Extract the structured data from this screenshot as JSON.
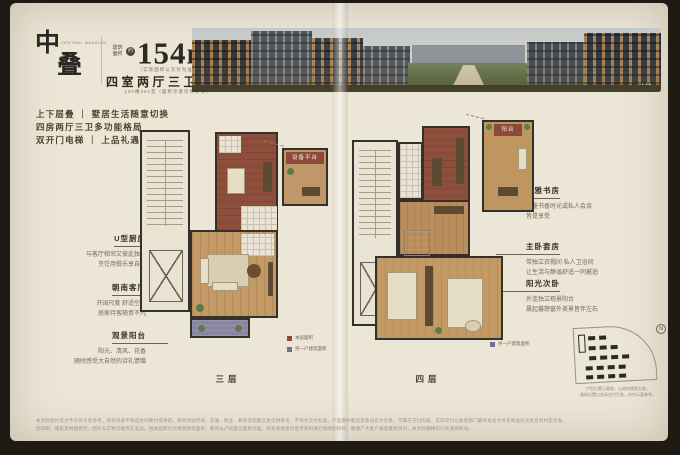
{
  "brand": {
    "logo_char_top": "中",
    "logo_char_bottom": "叠",
    "logo_subtext": "CENTRAL MANSION"
  },
  "headline": {
    "area_label": "建筑面积",
    "area_approx": "约",
    "area_value": "154m",
    "area_sup": "2",
    "area_note": "（实际面积以交付为准）",
    "layout": "四室两厅三卫一厨",
    "unit_note": "10#楼301室（面积示意仅供参考）"
  },
  "selling_points": [
    "上下层叠 ｜ 墅居生活随意切换",
    "四房两厅三卫多功能格局",
    "双开门电梯 ｜ 上品礼遇"
  ],
  "left_annotations": [
    {
      "title": "U型厨房",
      "line1": "与客厅相邻又彼此独立",
      "line2": "烹饪用餐乐享自在"
    },
    {
      "title": "朝南客厅",
      "line1": "开阔尺度 舒适空间",
      "line2": "居家待客随意不凡"
    },
    {
      "title": "观景阳台",
      "line1": "阳光、清风、花香",
      "line2": "随时感受大自然的诗礼馈赠"
    }
  ],
  "right_annotations": [
    {
      "title": "静雅书房",
      "line1": "翰墨书香时光或私人会谈",
      "line2": "皆是享受"
    },
    {
      "title": "主卧套房",
      "line1": "带独立衣帽间 私人卫浴间",
      "line2": "让生活与静谧舒适一同邂逅"
    },
    {
      "title": "阳光次卧",
      "line1": "外连独立观景阳台",
      "line2": "晨起暮憩窗外美景皆伴左右"
    }
  ],
  "plans": {
    "floor3_label": "三层",
    "floor4_label": "四层",
    "equipment_label": "设备平台",
    "balcony_label": "阳台",
    "legend": [
      {
        "color": "#8d4a39",
        "label": "本层面积"
      },
      {
        "color": "#6f6e99",
        "label": "另一户建筑面积"
      }
    ]
  },
  "siteplan": {
    "compass": "N",
    "caption_line1": "户型位置示意图，以政府规划为准。",
    "caption_line2": "具体位置以实际交付为准，仅作示意参考。"
  },
  "banner": {
    "dots": "•••"
  },
  "disclaimer": {
    "line1": "本资料图片及文字仅作示意参考，所有内容不构成合同要约或承诺。项目周边环境、交通、商业、教育等配套信息仅供参考，不作为交付标准。户型图中家具及陈设仅为示意，不属于交付内容。实际交付以政府部门最终批准文件及商品房买卖合同约定为准。",
    "line2": "因印刷、摄影及制图原因，图片与实物可能存在差异。相关面积均为预测建筑面积，最终以产权登记面积为准。开发商保留对宣传资料进行修改的权利，敬请广大客户留意最新资料。本资料解释权归开发商所有。"
  }
}
